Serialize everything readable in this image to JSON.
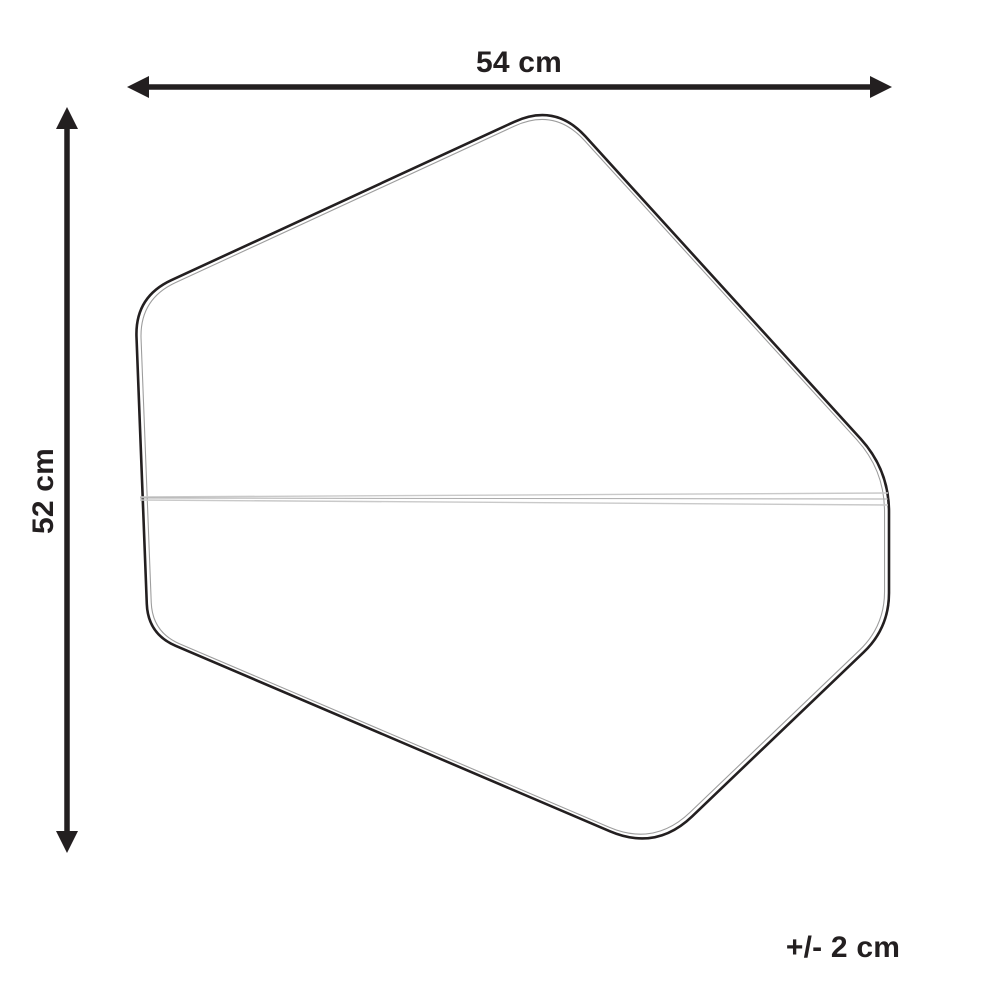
{
  "diagram": {
    "labels": {
      "width": "54 cm",
      "height": "52 cm",
      "tolerance": "+/- 2 cm"
    },
    "colors": {
      "ink": "#231f20",
      "outline": "#231f20",
      "inner_outline": "#9d9d9d",
      "seam_light": "#c9c9c9",
      "seam_mid": "#ababab",
      "background": "#ffffff"
    }
  }
}
